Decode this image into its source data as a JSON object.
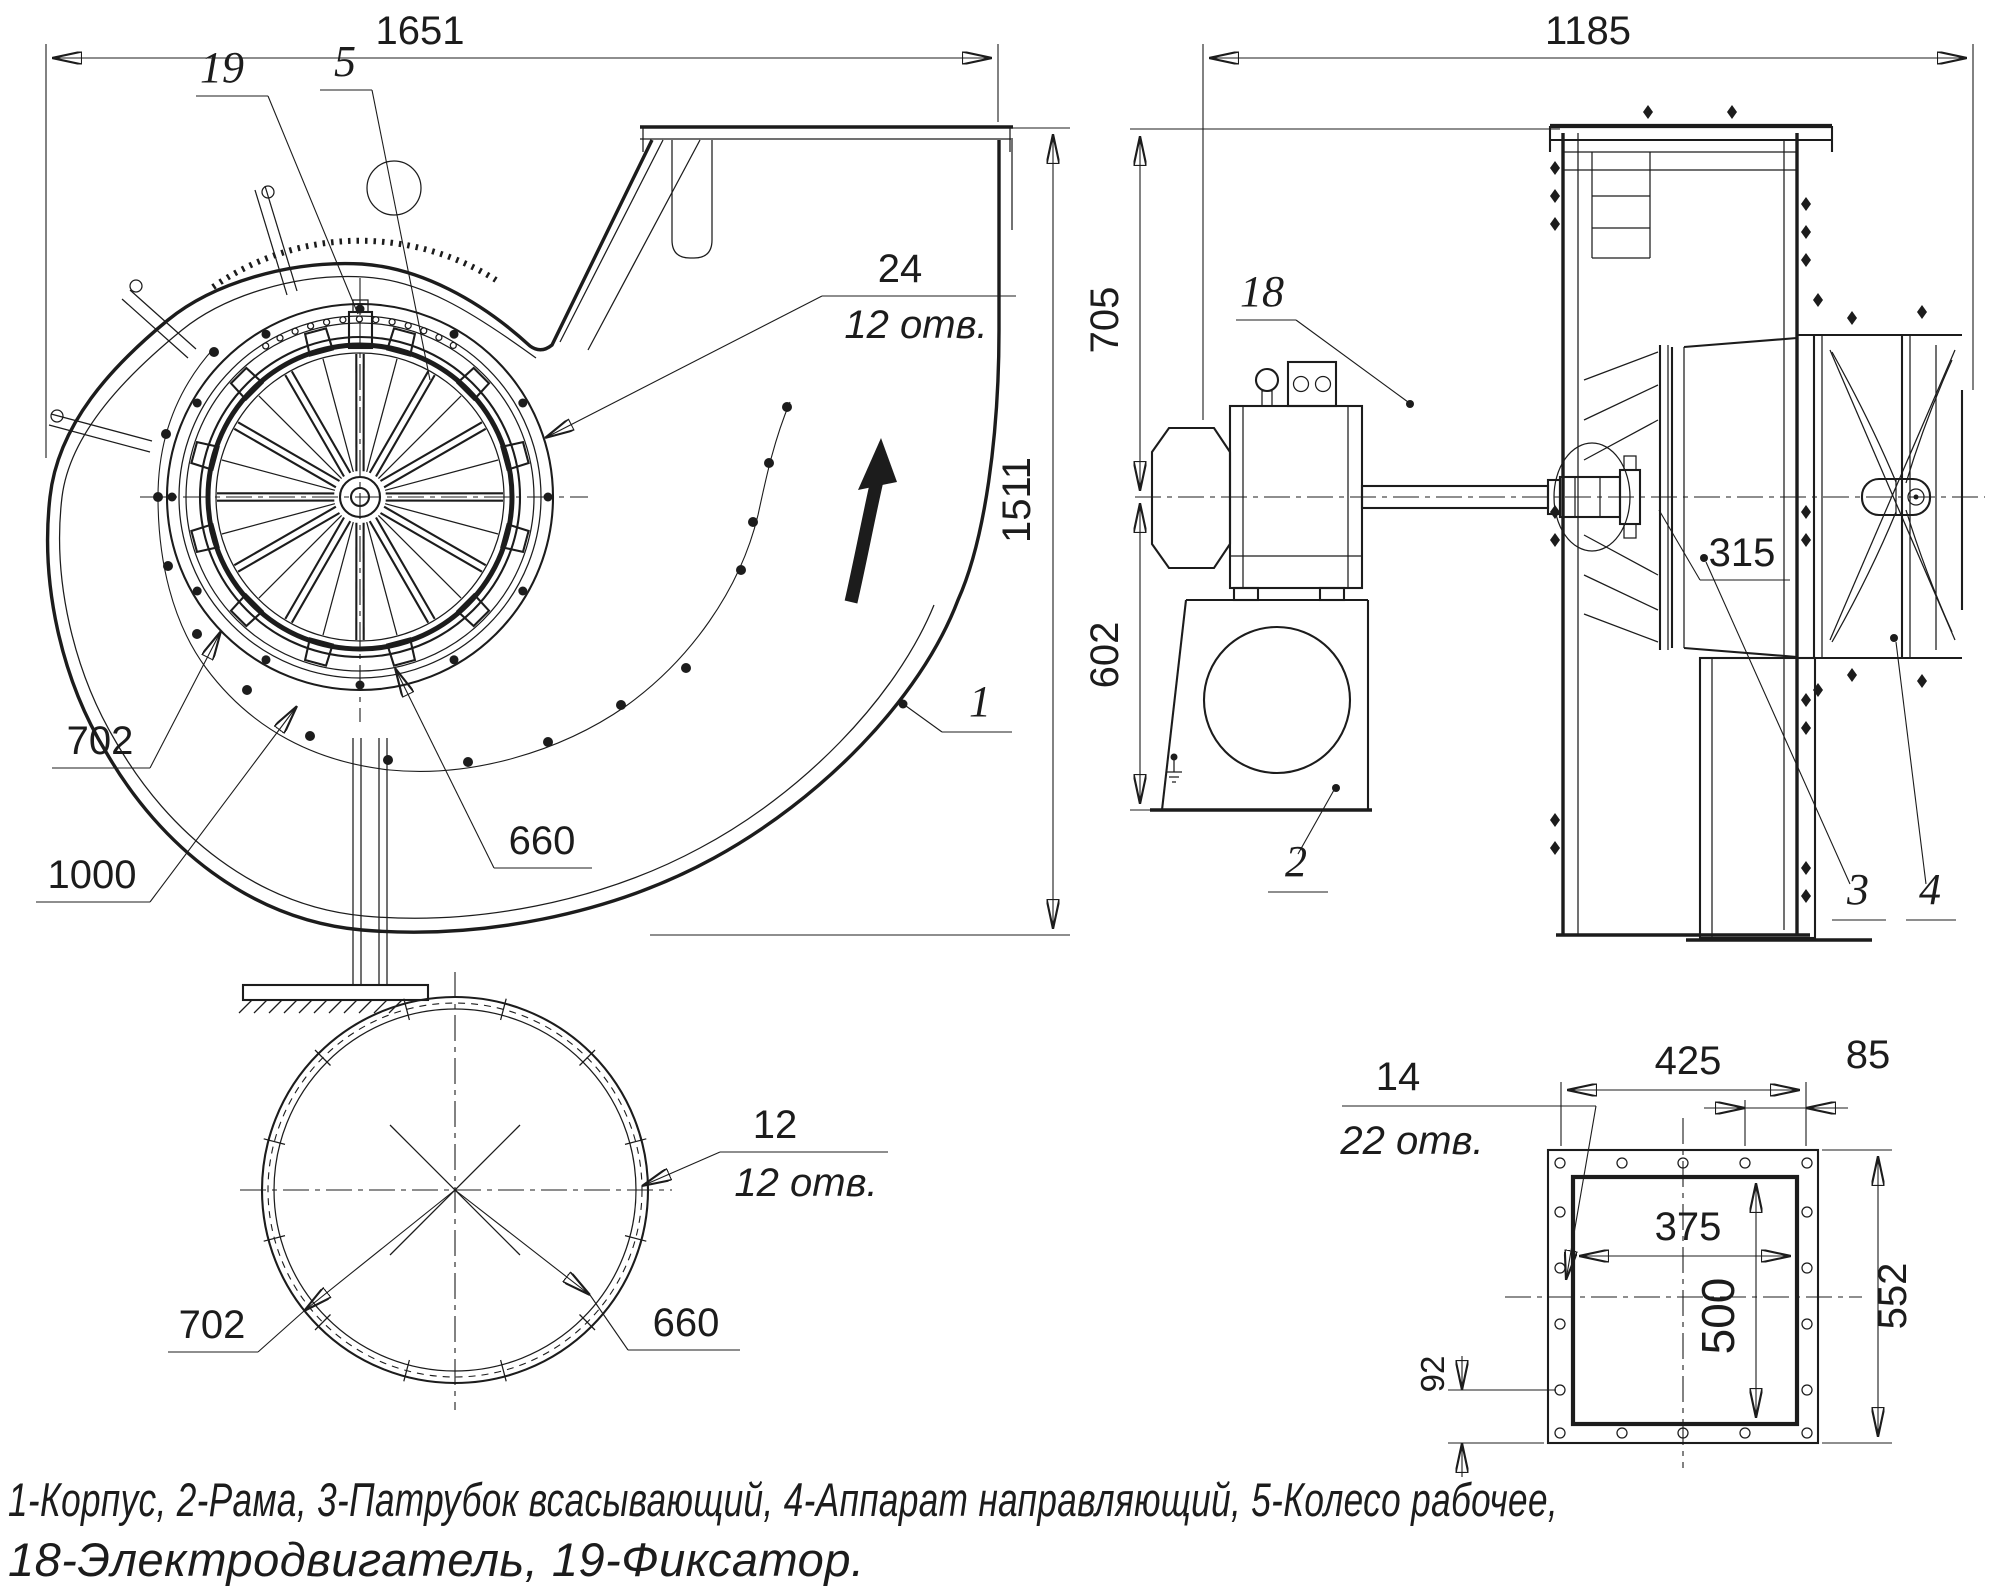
{
  "colors": {
    "ink": "#1c1c1c",
    "background": "#ffffff"
  },
  "front_view": {
    "dim_width": "1651",
    "dim_height": "1511",
    "label_19": "19",
    "label_5": "5",
    "holes_dia": "24",
    "holes_count": "12 отв.",
    "label_1": "1",
    "dim_impeller_outer": "702",
    "dim_leader_1000": "1000",
    "dim_impeller_inner": "660"
  },
  "side_view": {
    "dim_width": "1185",
    "dim_top": "705",
    "dim_bottom": "602",
    "dim_hub": "315",
    "label_18": "18",
    "label_2": "2",
    "label_3": "3",
    "label_4": "4"
  },
  "inlet_view": {
    "dim_outer": "702",
    "dim_bolt": "660",
    "holes_dia": "12",
    "holes_count": "12 отв."
  },
  "flange_view": {
    "dim_top_span": "425",
    "dim_offset": "85",
    "dim_inner_width": "375",
    "dim_inner_height": "500",
    "dim_overall_height": "552",
    "dim_bottom_offset": "92",
    "holes_dia": "14",
    "holes_count": "22 отв."
  },
  "legend": {
    "line1": "1-Корпус, 2-Рама, 3-Патрубок всасывающий, 4-Аппарат направляющий, 5-Колесо рабочее,",
    "line2": "18-Электродвигатель, 19-Фиксатор."
  }
}
